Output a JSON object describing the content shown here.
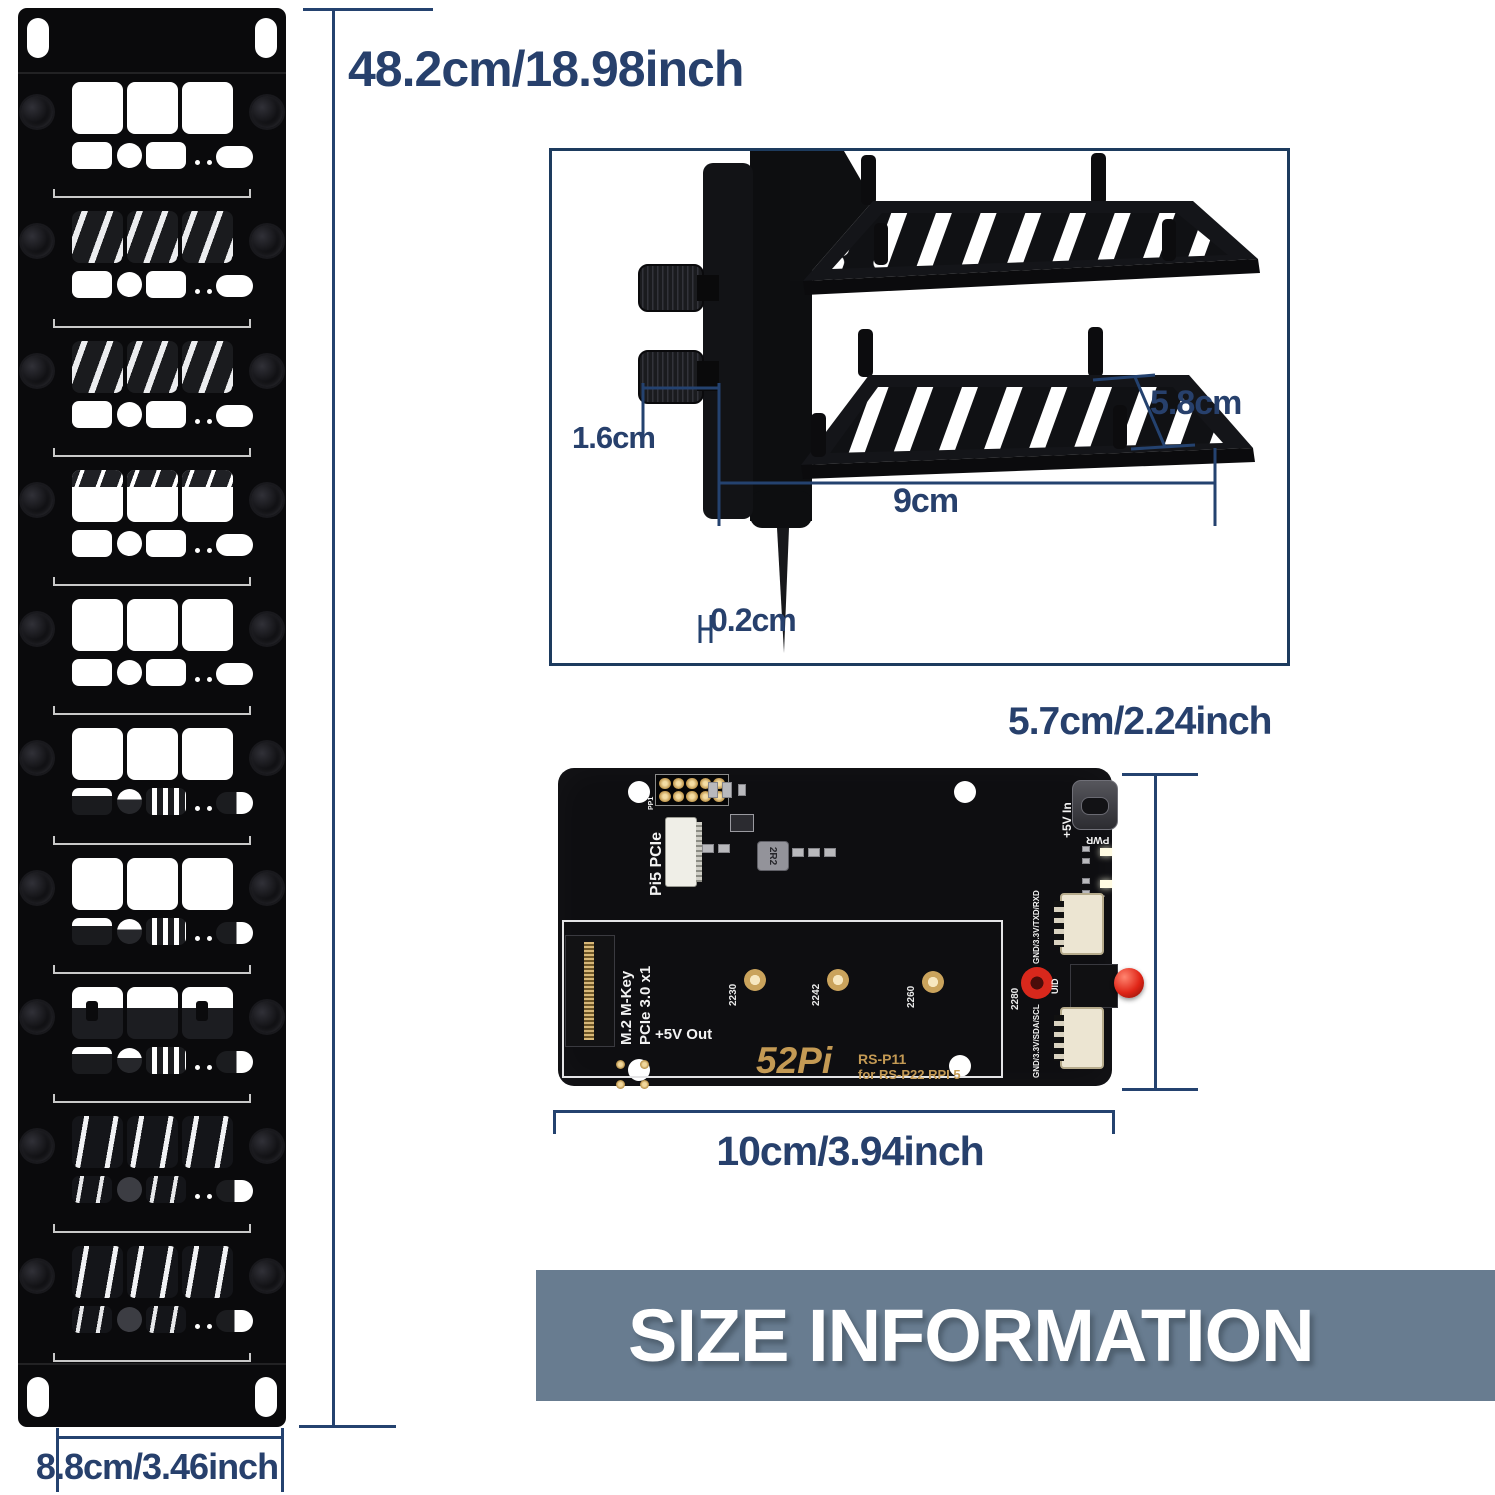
{
  "title_banner": {
    "text": "SIZE INFORMATION",
    "bg_color": "#687c90",
    "text_color": "#ffffff"
  },
  "colors": {
    "dimension_text": "#27406c",
    "dimension_line": "#24426f",
    "box_border": "#1d3b5e",
    "panel_black": "#0a0a0c",
    "pcb_black": "#0e0e11",
    "gold": "#c49a54",
    "button_red": "#d8281c"
  },
  "dimensions": {
    "panel_height": "48.2cm/18.98inch",
    "panel_width": "8.8cm/3.46inch",
    "bracket_offset": "1.6cm",
    "bracket_depth": "5.8cm",
    "bracket_width": "9cm",
    "bracket_thickness": "0.2cm",
    "pcb_height": "5.7cm/2.24inch",
    "pcb_width": "10cm/3.94inch"
  },
  "rack_panel": {
    "bays": [
      "empty",
      "vent",
      "vent",
      "vent-partial",
      "empty",
      "device",
      "device",
      "device-shelf",
      "vent-dark",
      "vent-dark"
    ]
  },
  "pcb": {
    "labels": {
      "pp1": "PP1",
      "pi5_pcie": "Pi5 PCIe",
      "inductor": "2R2",
      "m2_line1": "M.2 M-Key",
      "m2_line2": "PCIe 3.0 x1",
      "power_in": "+5V In",
      "pwr_led": "PWR",
      "act_led": "ACT",
      "uart_header": "GND/3.3V/TXD/RXD",
      "uid": "UID",
      "i2c_header": "GND/3.3V/SDA/SCL",
      "power_out": "+5V Out",
      "logo": "52Pi",
      "model": "RS-P11",
      "model_sub": "for RS-P22 RPI 5"
    },
    "standoffs": [
      "2230",
      "2242",
      "2260",
      "2280"
    ]
  }
}
